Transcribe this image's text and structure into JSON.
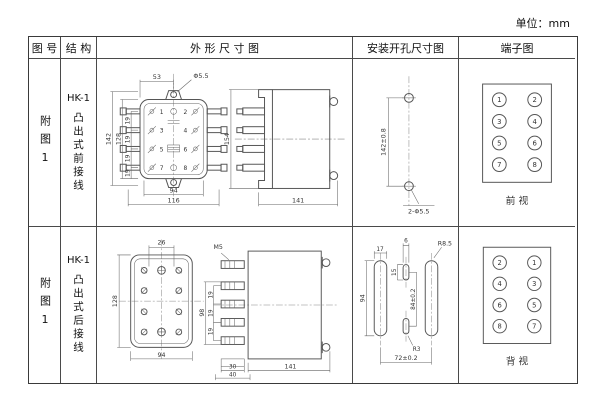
{
  "unit_label": "单位：mm",
  "header": {
    "figure": "图 号",
    "structure": "结 构",
    "outline": "外 形 尺 寸 图",
    "install": "安装开孔尺寸图",
    "terminal": "端子图"
  },
  "rows": [
    {
      "figure_no": "附图1",
      "model": "HK-1",
      "structure": "凸出式前接线",
      "outline": {
        "front": {
          "top_width": "53",
          "hole_dia": "Φ5.5",
          "height_outer": "142",
          "height_inner": "128",
          "pitch": [
            "19",
            "19",
            "19",
            "19"
          ],
          "width_inner": "94",
          "width_outer": "116",
          "left_terms": [
            "1",
            "3",
            "5",
            "7"
          ],
          "right_terms": [
            "2",
            "4",
            "6",
            "8"
          ]
        },
        "side": {
          "height": "154",
          "depth": "141"
        }
      },
      "install": {
        "pitch": "142±0.8",
        "holes": "2-Φ5.5"
      },
      "terminal": {
        "left": [
          "1",
          "3",
          "5",
          "7"
        ],
        "right": [
          "2",
          "4",
          "6",
          "8"
        ],
        "view": "前  视"
      }
    },
    {
      "figure_no": "附图1",
      "model": "HK-1",
      "structure": "凸出式后接线",
      "outline": {
        "front": {
          "top_pitch": "26",
          "height": "128",
          "width": "94"
        },
        "side": {
          "thread": "M5",
          "span": "98",
          "pitch": [
            "19",
            "19",
            "19"
          ],
          "base1": "30",
          "base2": "40",
          "depth": "141"
        }
      },
      "install": {
        "slot_w": "17",
        "mid_w": "6",
        "mid_h": "15",
        "slot_h": "94",
        "mid_pitch": "84±0.2",
        "r_outer": "R8.5",
        "r_mid": "R3",
        "h_pitch": "72±0.2"
      },
      "terminal": {
        "left": [
          "2",
          "4",
          "6",
          "8"
        ],
        "right": [
          "1",
          "3",
          "5",
          "7"
        ],
        "view": "背  视"
      }
    }
  ]
}
